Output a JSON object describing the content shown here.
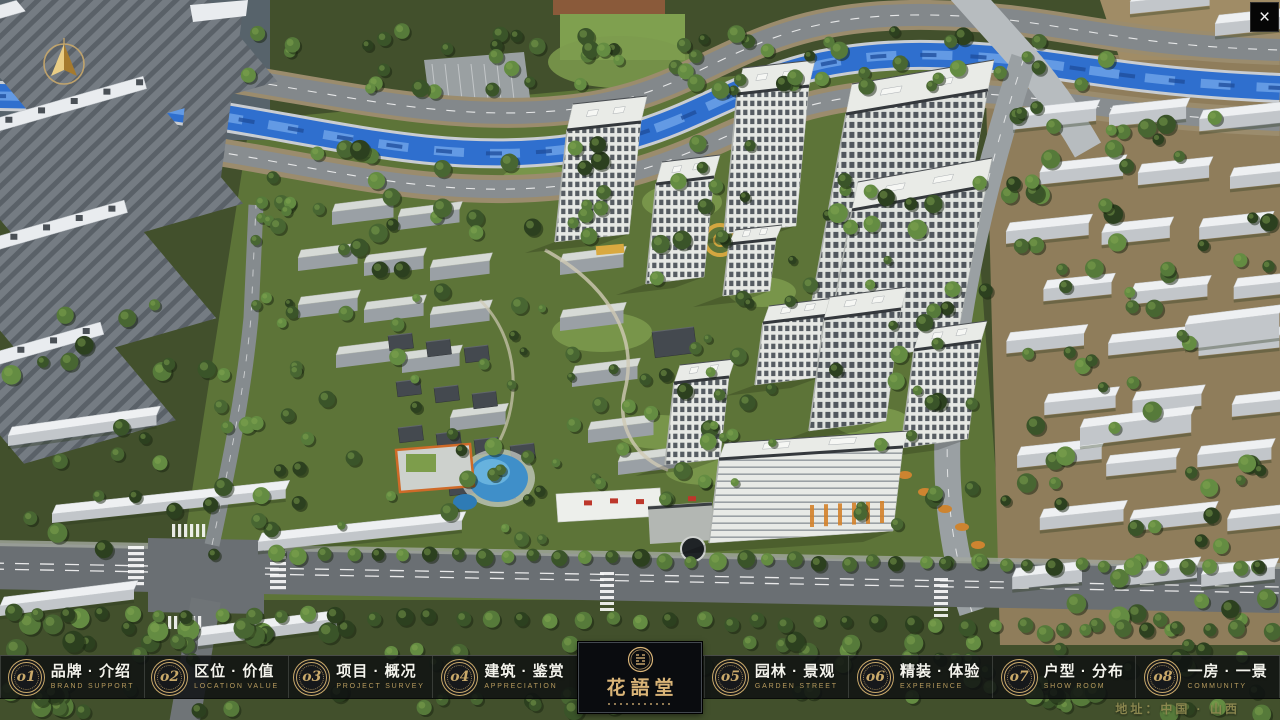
{
  "window": {
    "close_label": "×"
  },
  "logo": {
    "name": "花語堂"
  },
  "nav": {
    "items": [
      {
        "num": "o1",
        "title": "品牌 · 介绍",
        "subtitle": "BRAND SUPPORT"
      },
      {
        "num": "o2",
        "title": "区位 · 价值",
        "subtitle": "LOCATION VALUE"
      },
      {
        "num": "o3",
        "title": "项目 · 概况",
        "subtitle": "PROJECT SURVEY"
      },
      {
        "num": "o4",
        "title": "建筑 · 鉴赏",
        "subtitle": "APPRECIATION"
      },
      {
        "num": "o5",
        "title": "园林 · 景观",
        "subtitle": "GARDEN STREET"
      },
      {
        "num": "o6",
        "title": "精装 · 体验",
        "subtitle": "EXPERIENCE"
      },
      {
        "num": "o7",
        "title": "户型 · 分布",
        "subtitle": "SHOW ROOM"
      },
      {
        "num": "o8",
        "title": "一房 · 一景",
        "subtitle": "COMMUNITY"
      }
    ]
  },
  "footer": {
    "address": "地址：中国 · 山西"
  },
  "colors": {
    "gold": "#c9a96a",
    "gold_dim": "#b3965b",
    "bar_bg": "rgba(14,16,18,0.85)",
    "river_blue": "#2f6fce",
    "accent_red": "#bd372b"
  }
}
